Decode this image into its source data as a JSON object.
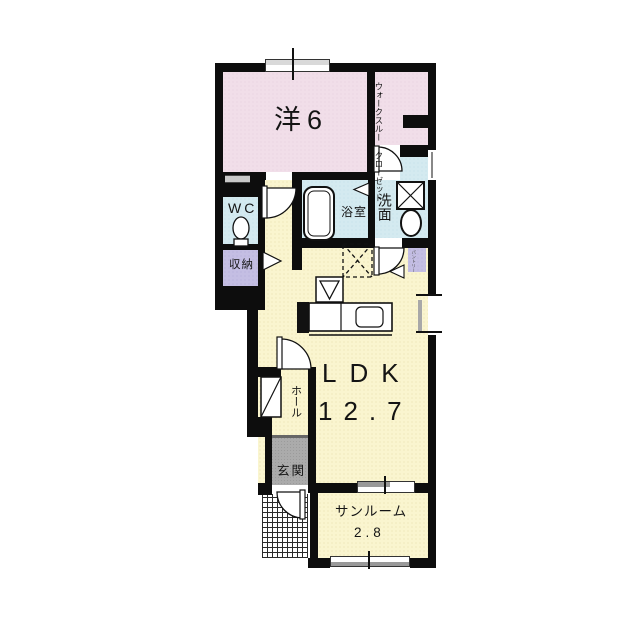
{
  "rooms": {
    "western": {
      "label": "洋6"
    },
    "wtc": {
      "line1": "ウォークスルー",
      "line2": "クローゼット"
    },
    "wc": {
      "label": "WC"
    },
    "bath": {
      "label": "浴室"
    },
    "washroom": {
      "label": "洗面"
    },
    "storage": {
      "label": "収納"
    },
    "pantry": {
      "label": "パントリー"
    },
    "ldk": {
      "label": "LDK",
      "size": "12.7"
    },
    "hall": {
      "label": "ホール"
    },
    "entrance": {
      "label": "玄関"
    },
    "sunroom": {
      "label": "サンルーム",
      "size": "2.8"
    }
  },
  "colors": {
    "room_pink": "#F1DEE9",
    "room_yellow": "#FAF5CF",
    "room_blue": "#D4EAF0",
    "room_purple": "#C4BEE3",
    "entrance_gray": "#ABABAB",
    "wall_black": "#0d0d0d",
    "background": "#FFFFFF"
  }
}
